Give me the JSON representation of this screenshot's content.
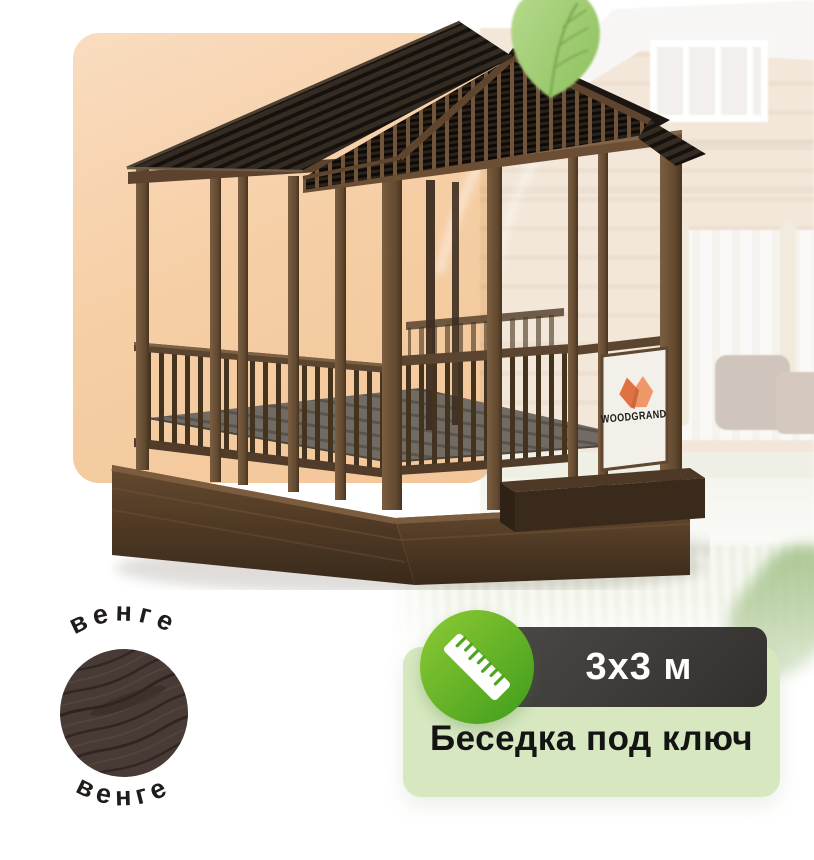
{
  "promo": {
    "size": "3x3 м",
    "title": "Беседка под ключ"
  },
  "swatch": {
    "top_label": "венге",
    "bottom_label": "венге"
  },
  "sign": {
    "brand": "WOODGRAND"
  },
  "icons": {
    "ruler": "ruler-icon",
    "leaf": "leaf-icon"
  },
  "colors": {
    "accent_green_light": "#8ecb35",
    "accent_green_dark": "#3f9c1b",
    "promo_card_bg": "#d7e8c1",
    "size_badge_bg": "#322f2d",
    "peach_panel_bg": "#f6cfa6",
    "logo_orange": "#e8764a",
    "wood_dark": "#463834",
    "roof_dark": "#17110d"
  }
}
